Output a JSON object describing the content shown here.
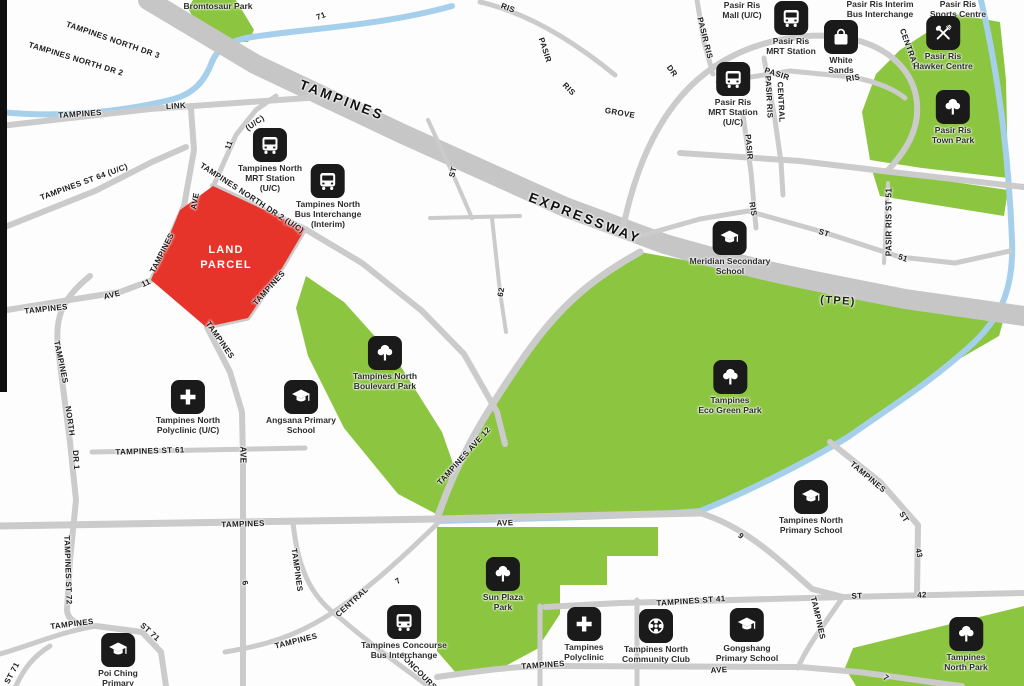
{
  "map": {
    "land_parcel": {
      "label": "LAND\nPARCEL",
      "color": "#e6342b"
    },
    "colors": {
      "park_green": "#8cc53f",
      "road_gray": "#cbcbcb",
      "expressway_gray": "#c6c6c6",
      "water_blue": "#a6cfec",
      "marker_black": "#1a1a1a"
    },
    "pois": {
      "bromtosaur": {
        "icon": null,
        "label": "Bromtosaur Park"
      },
      "tampines_north_mrt": {
        "icon": "bus-icon",
        "label": "Tampines North\nMRT Station\n(U/C)"
      },
      "tampines_north_bus": {
        "icon": "bus-icon",
        "label": "Tampines North\nBus Interchange\n(Interim)"
      },
      "pasir_ris_mall": {
        "icon": null,
        "label": "Pasir Ris\nMall (U/C)"
      },
      "pasir_ris_mrt": {
        "icon": "bus-icon",
        "label": "Pasir Ris\nMRT Station"
      },
      "pasir_ris_interim_bus": {
        "icon": null,
        "label": "Pasir Ris Interim\nBus Interchange"
      },
      "pasir_ris_sports": {
        "icon": null,
        "label": "Pasir Ris\nSports Centre"
      },
      "pasir_ris_mrt_uc": {
        "icon": "bus-icon",
        "label": "Pasir Ris\nMRT Station\n(U/C)"
      },
      "white_sands": {
        "icon": "shopping-bag-icon",
        "label": "White\nSands"
      },
      "hawker": {
        "icon": "utensils-icon",
        "label": "Pasir Ris\nHawker Centre"
      },
      "pr_town_park": {
        "icon": "tree-icon",
        "label": "Pasir Ris\nTown Park"
      },
      "meridian": {
        "icon": "school-icon",
        "label": "Meridian Secondary\nSchool"
      },
      "eco_green": {
        "icon": "tree-icon",
        "label": "Tampines\nEco Green Park"
      },
      "boulevard": {
        "icon": "tree-icon",
        "label": "Tampines North\nBoulevard Park"
      },
      "angsana": {
        "icon": "school-icon",
        "label": "Angsana Primary\nSchool"
      },
      "tn_polyclinic": {
        "icon": "cross-icon",
        "label": "Tampines North\nPolyclinic (U/C)"
      },
      "poi_ching": {
        "icon": "school-icon",
        "label": "Poi Ching\nPrimary\nSchool"
      },
      "concourse_bus": {
        "icon": "bus-icon",
        "label": "Tampines Concourse\nBus Interchange"
      },
      "sun_plaza": {
        "icon": "tree-icon",
        "label": "Sun Plaza\nPark"
      },
      "t_polyclinic": {
        "icon": "cross-icon",
        "label": "Tampines\nPolyclinic"
      },
      "tn_cc": {
        "icon": "community-club-icon",
        "label": "Tampines North\nCommunity Club"
      },
      "gongshang": {
        "icon": "school-icon",
        "label": "Gongshang\nPrimary School"
      },
      "tn_primary": {
        "icon": "school-icon",
        "label": "Tampines North\nPrimary School"
      },
      "tn_park": {
        "icon": "tree-icon",
        "label": "Tampines\nNorth Park"
      }
    },
    "road_labels": {
      "tnd3": "TAMPINES NORTH DR 3",
      "tnd2": "TAMPINES NORTH DR 2",
      "link_a": "TAMPINES",
      "link_b": "LINK",
      "n71": "71",
      "expwy_a": "TAMPINES",
      "expwy_b": "EXPRESSWAY",
      "tpe": "(TPE)",
      "st64": "TAMPINES ST 64 (U/C)",
      "uc": "(U/C)",
      "n11": "11",
      "ave1": "AVE",
      "dr2uc": "TAMPINES NORTH DR 2 (U/C)",
      "tamp_w": "TAMPINES",
      "tamp_se": "TAMPINES",
      "tamp_s": "TAMPINES",
      "ave11_a": "TAMPINES",
      "ave11_b": "AVE",
      "ave11_c": "11",
      "dr1_a": "TAMPINES",
      "dr1_b": "NORTH",
      "dr1_c": "DR 1",
      "st61": "TAMPINES ST 61",
      "ave2": "AVE",
      "n6": "6",
      "ave9_a": "TAMPINES",
      "ave9_b": "AVE",
      "n9": "9",
      "st72": "TAMPINES ST 72",
      "st71_a": "TAMPINES",
      "st71_b": "ST 71",
      "st71_c": "ST 71",
      "cen_a": "TAMPINES",
      "cen_b": "CENTRAL",
      "n7a": "7",
      "tamp_v": "TAMPINES",
      "concourse": "CONCOURSE",
      "ave12": "TAMPINES AVE 12",
      "st_m": "ST",
      "n62": "62",
      "st41": "TAMPINES ST 41",
      "st42_a": "ST",
      "st42_b": "42",
      "st43_a": "TAMPINES",
      "st43_b": "ST",
      "st43_c": "43",
      "tamp_v2": "TAMPINES",
      "aveb_a": "TAMPINES",
      "aveb_b": "AVE",
      "n7b": "7",
      "pr_v1": "PASIR RIS",
      "pr_a": "PASIR",
      "pr_b": "RIS",
      "cen_l": "CENTRAL",
      "prc_a": "PASIR RIS",
      "prc_b": "CENTRAL",
      "pr_v2a": "PASIR",
      "pr_v2b": "RIS",
      "pr_top": "RIS",
      "grov_a": "PASIR",
      "grov_b": "RIS",
      "grov_c": "GROVE",
      "dr_s": "DR",
      "st51_a": "ST",
      "st51_b": "51",
      "st51_v": "PASIR RIS ST 51"
    }
  }
}
